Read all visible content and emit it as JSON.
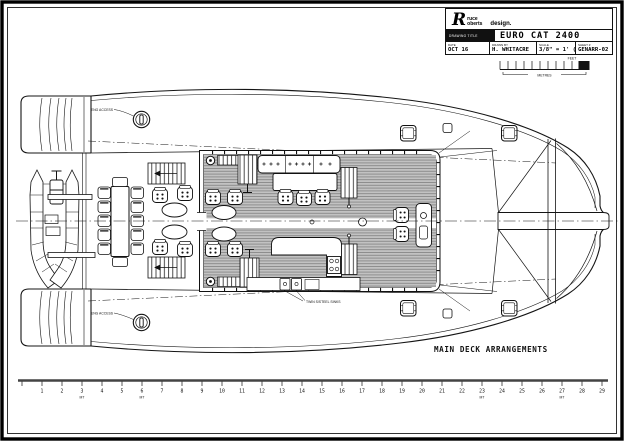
{
  "title_block": {
    "logo": {
      "initial": "R",
      "name_top": "ruce",
      "name_bottom": "oberts",
      "suffix": "design."
    },
    "drawing_title_label": "DRAWING TITLE",
    "drawing_title": "EURO CAT 2400",
    "fields": [
      {
        "label": "DATE",
        "value": "OCT 16"
      },
      {
        "label": "DRAWN BY",
        "value": "H. WHITACRE"
      },
      {
        "label": "SCALE",
        "value": "3/8\" = 1' (32)"
      },
      {
        "label": "SHEET #",
        "value": "GENARR-02"
      }
    ]
  },
  "scale_bar": {
    "top_label": "FEET",
    "bottom_label": "METRES"
  },
  "drawing": {
    "caption": "MAIN DECK ARRANGEMENTS",
    "labels": {
      "port_engine_hatch": "ENG ACCESS",
      "starboard_engine_hatch": "ENG ACCESS",
      "galley_sinks": "TWIN S/STEEL SINKS"
    }
  },
  "ruler": {
    "numbers": [
      1,
      2,
      3,
      4,
      5,
      6,
      7,
      8,
      9,
      10,
      11,
      12,
      13,
      14,
      15,
      16,
      17,
      18,
      19,
      20,
      21,
      22,
      23,
      24,
      25,
      26,
      27,
      28,
      29
    ],
    "unit": "MT",
    "unit_positions": [
      3,
      6,
      23,
      27
    ]
  }
}
